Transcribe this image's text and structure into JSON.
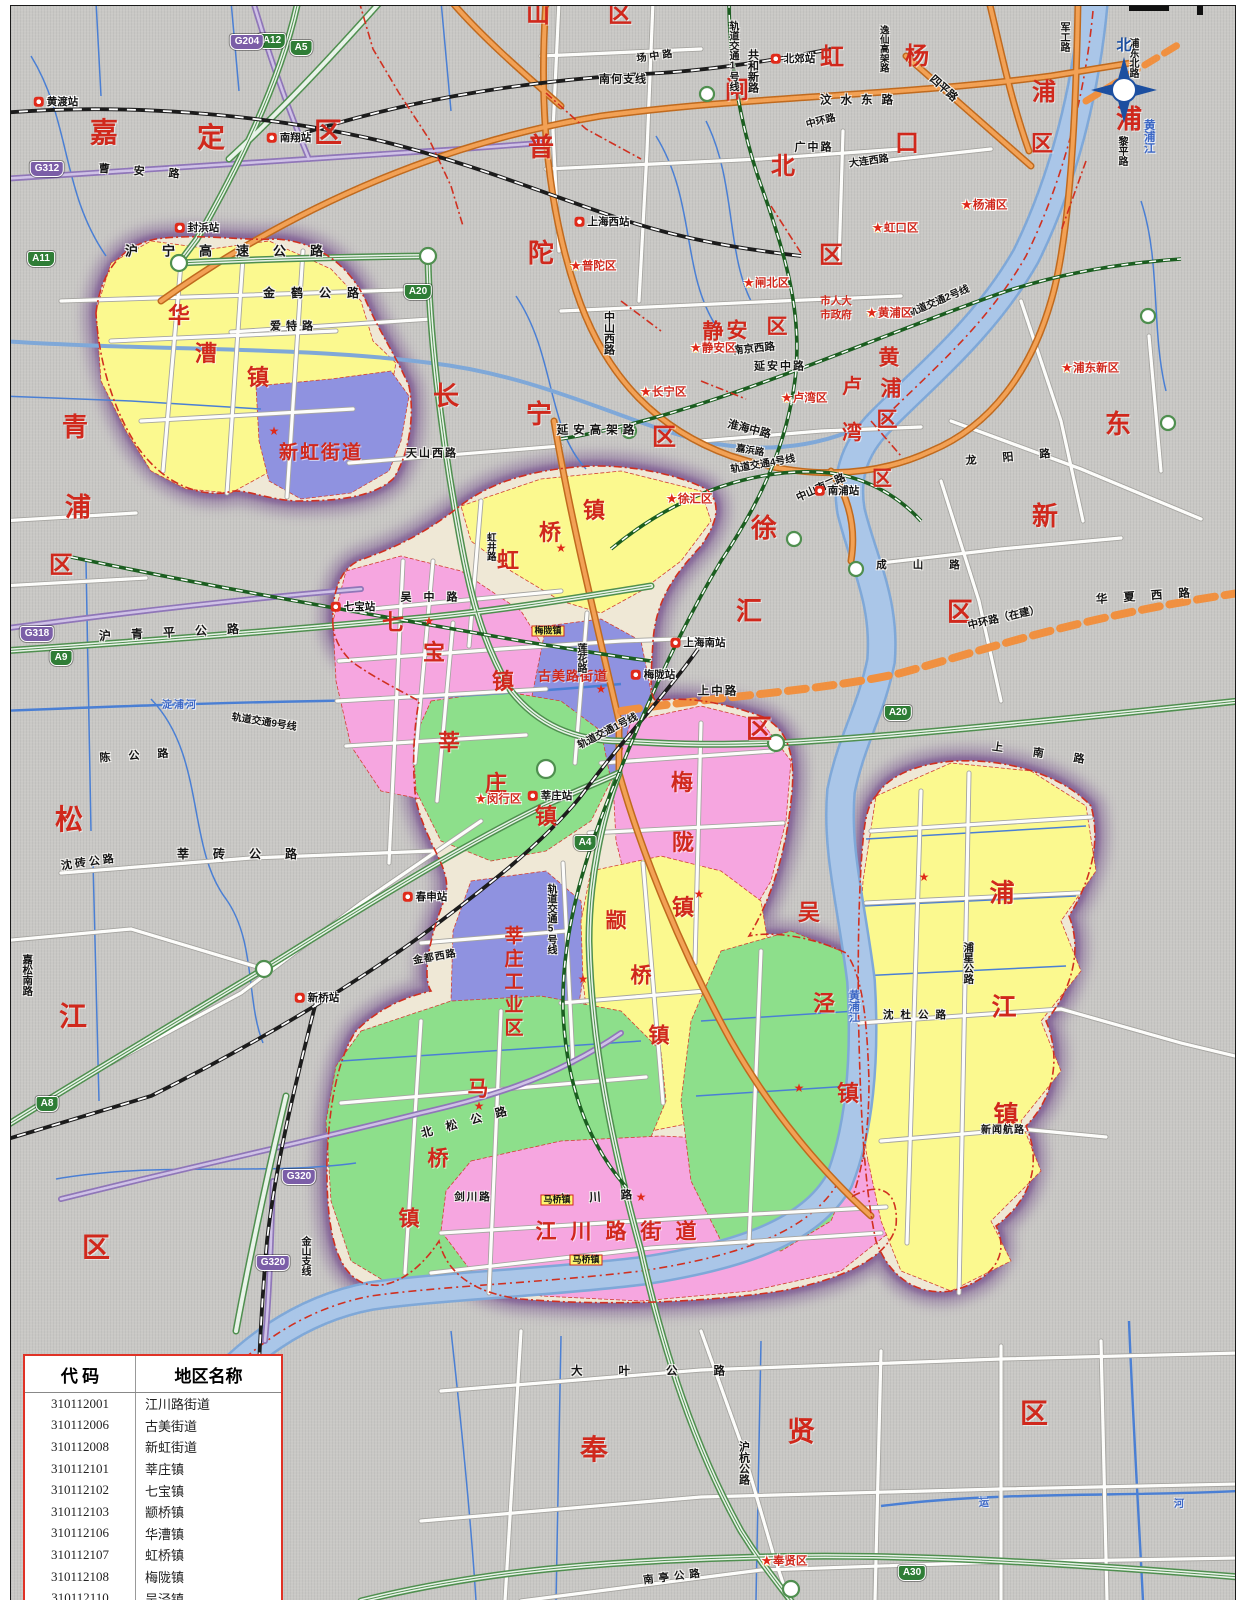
{
  "palette": {
    "bg": "#c9c8c5",
    "yellow_town": "#fbf98f",
    "pink_town": "#f6a6e0",
    "green_town": "#8ddf8b",
    "violet_town": "#8f92e0",
    "halo_purple": "#6d4388",
    "district_red": "#d0281c",
    "highway_green": "#4f8f4f",
    "major_orange": "#cf7a26",
    "g_road_purple": "#8f76b8",
    "river_blue": "#a9c5e6",
    "legend_border": "#e03226"
  },
  "compass": {
    "north_label": "北"
  },
  "legend": {
    "header": {
      "code": "代 码",
      "name": "地区名称"
    },
    "rows": [
      {
        "code": "310112001",
        "name": "江川路街道"
      },
      {
        "code": "310112006",
        "name": "古美街道"
      },
      {
        "code": "310112008",
        "name": "新虹街道"
      },
      {
        "code": "310112101",
        "name": "莘庄镇"
      },
      {
        "code": "310112102",
        "name": "七宝镇"
      },
      {
        "code": "310112103",
        "name": "颛桥镇"
      },
      {
        "code": "310112106",
        "name": "华漕镇"
      },
      {
        "code": "310112107",
        "name": "虹桥镇"
      },
      {
        "code": "310112108",
        "name": "梅陇镇"
      },
      {
        "code": "310112110",
        "name": "吴泾镇"
      },
      {
        "code": "310112112",
        "name": "马桥镇"
      },
      {
        "code": "310112114",
        "name": "浦江镇"
      },
      {
        "code": "310112501",
        "name": "莘庄工业区"
      }
    ]
  },
  "districts": [
    {
      "t": "嘉",
      "x": 103,
      "y": 133,
      "s": 28
    },
    {
      "t": "定",
      "x": 210,
      "y": 138,
      "s": 28
    },
    {
      "t": "区",
      "x": 327,
      "y": 133,
      "s": 28
    },
    {
      "t": "山",
      "x": 537,
      "y": 14,
      "s": 24
    },
    {
      "t": "区",
      "x": 619,
      "y": 14,
      "s": 24
    },
    {
      "t": "普",
      "x": 540,
      "y": 147,
      "s": 26
    },
    {
      "t": "陀",
      "x": 540,
      "y": 253,
      "s": 26
    },
    {
      "t": "区",
      "x": 830,
      "y": 255,
      "s": 24
    },
    {
      "t": "闸",
      "x": 736,
      "y": 90,
      "s": 24
    },
    {
      "t": "北",
      "x": 782,
      "y": 166,
      "s": 24
    },
    {
      "t": "虹",
      "x": 831,
      "y": 57,
      "s": 24
    },
    {
      "t": "口",
      "x": 906,
      "y": 143,
      "s": 24
    },
    {
      "t": "杨",
      "x": 916,
      "y": 56,
      "s": 24
    },
    {
      "t": "浦",
      "x": 1043,
      "y": 92,
      "s": 24
    },
    {
      "t": "区",
      "x": 1041,
      "y": 143,
      "s": 22
    },
    {
      "t": "浦",
      "x": 1128,
      "y": 119,
      "s": 26
    },
    {
      "t": "东",
      "x": 1117,
      "y": 424,
      "s": 26
    },
    {
      "t": "新",
      "x": 1044,
      "y": 516,
      "s": 26
    },
    {
      "t": "区",
      "x": 959,
      "y": 612,
      "s": 26
    },
    {
      "t": "青",
      "x": 74,
      "y": 427,
      "s": 26
    },
    {
      "t": "浦",
      "x": 77,
      "y": 507,
      "s": 26
    },
    {
      "t": "区",
      "x": 60,
      "y": 565,
      "s": 24
    },
    {
      "t": "长",
      "x": 445,
      "y": 396,
      "s": 26
    },
    {
      "t": "宁",
      "x": 538,
      "y": 414,
      "s": 26
    },
    {
      "t": "区",
      "x": 663,
      "y": 437,
      "s": 24
    },
    {
      "t": "静",
      "x": 712,
      "y": 331,
      "s": 21
    },
    {
      "t": "安",
      "x": 736,
      "y": 330,
      "s": 21
    },
    {
      "t": "区",
      "x": 776,
      "y": 326,
      "s": 21
    },
    {
      "t": "黄",
      "x": 888,
      "y": 357,
      "s": 21
    },
    {
      "t": "浦",
      "x": 890,
      "y": 388,
      "s": 21
    },
    {
      "t": "区",
      "x": 886,
      "y": 419,
      "s": 21
    },
    {
      "t": "卢",
      "x": 851,
      "y": 386,
      "s": 20
    },
    {
      "t": "湾",
      "x": 851,
      "y": 432,
      "s": 20
    },
    {
      "t": "区",
      "x": 881,
      "y": 478,
      "s": 20
    },
    {
      "t": "徐",
      "x": 763,
      "y": 528,
      "s": 26
    },
    {
      "t": "汇",
      "x": 748,
      "y": 611,
      "s": 26
    },
    {
      "t": "区",
      "x": 758,
      "y": 729,
      "s": 26
    },
    {
      "t": "松",
      "x": 68,
      "y": 820,
      "s": 28
    },
    {
      "t": "江",
      "x": 72,
      "y": 1017,
      "s": 28
    },
    {
      "t": "区",
      "x": 95,
      "y": 1248,
      "s": 28
    },
    {
      "t": "奉",
      "x": 593,
      "y": 1450,
      "s": 28
    },
    {
      "t": "贤",
      "x": 800,
      "y": 1432,
      "s": 28
    },
    {
      "t": "区",
      "x": 1033,
      "y": 1414,
      "s": 28
    }
  ],
  "towns": [
    {
      "t": "华",
      "x": 178,
      "y": 315,
      "s": 22
    },
    {
      "t": "漕",
      "x": 205,
      "y": 353,
      "s": 22
    },
    {
      "t": "镇",
      "x": 257,
      "y": 377,
      "s": 22
    },
    {
      "t": "新虹街道",
      "x": 320,
      "y": 452,
      "s": 19,
      "ls": 2
    },
    {
      "t": "七",
      "x": 392,
      "y": 622,
      "s": 22
    },
    {
      "t": "宝",
      "x": 433,
      "y": 652,
      "s": 22
    },
    {
      "t": "镇",
      "x": 502,
      "y": 681,
      "s": 22
    },
    {
      "t": "镇",
      "x": 593,
      "y": 510,
      "s": 22
    },
    {
      "t": "桥",
      "x": 549,
      "y": 532,
      "s": 22
    },
    {
      "t": "虹",
      "x": 507,
      "y": 560,
      "s": 22
    },
    {
      "t": "古美路街道",
      "x": 572,
      "y": 675,
      "s": 13,
      "ls": 1
    },
    {
      "t": "莘",
      "x": 448,
      "y": 742,
      "s": 22
    },
    {
      "t": "庄",
      "x": 495,
      "y": 783,
      "s": 22
    },
    {
      "t": "镇",
      "x": 545,
      "y": 816,
      "s": 22
    },
    {
      "t": "莘庄工业区",
      "x": 511,
      "y": 982,
      "s": 19,
      "v": 1,
      "ls": 4
    },
    {
      "t": "颛",
      "x": 615,
      "y": 920,
      "s": 21
    },
    {
      "t": "桥",
      "x": 640,
      "y": 975,
      "s": 21
    },
    {
      "t": "镇",
      "x": 658,
      "y": 1035,
      "s": 21
    },
    {
      "t": "梅",
      "x": 681,
      "y": 782,
      "s": 22
    },
    {
      "t": "陇",
      "x": 682,
      "y": 842,
      "s": 22
    },
    {
      "t": "镇",
      "x": 682,
      "y": 907,
      "s": 22
    },
    {
      "t": "吴",
      "x": 808,
      "y": 912,
      "s": 22
    },
    {
      "t": "泾",
      "x": 823,
      "y": 1003,
      "s": 22
    },
    {
      "t": "镇",
      "x": 847,
      "y": 1093,
      "s": 22
    },
    {
      "t": "马",
      "x": 477,
      "y": 1088,
      "s": 21
    },
    {
      "t": "桥",
      "x": 437,
      "y": 1158,
      "s": 21
    },
    {
      "t": "镇",
      "x": 408,
      "y": 1218,
      "s": 21
    },
    {
      "t": "江川路街道",
      "x": 622,
      "y": 1231,
      "s": 21,
      "ls": 14
    },
    {
      "t": "浦",
      "x": 1001,
      "y": 893,
      "s": 25
    },
    {
      "t": "江",
      "x": 1003,
      "y": 1007,
      "s": 25
    },
    {
      "t": "镇",
      "x": 1005,
      "y": 1115,
      "s": 25
    }
  ],
  "roads": [
    {
      "t": "沪宁高速公路",
      "x": 235,
      "y": 250,
      "s": 13,
      "ls": 24
    },
    {
      "t": "金鹤公路",
      "x": 318,
      "y": 292,
      "s": 12,
      "ls": 16
    },
    {
      "t": "爱特路",
      "x": 293,
      "y": 326,
      "s": 11,
      "ls": 5
    },
    {
      "t": "曹安路",
      "x": 150,
      "y": 172,
      "s": 11,
      "ls": 24,
      "r": 4
    },
    {
      "t": "南何支线",
      "x": 622,
      "y": 79,
      "s": 11,
      "ls": 1
    },
    {
      "t": "场中路",
      "x": 655,
      "y": 56,
      "s": 10,
      "ls": 3,
      "r": -8
    },
    {
      "t": "汶水东路",
      "x": 860,
      "y": 100,
      "s": 11.5,
      "ls": 9
    },
    {
      "t": "共和新路",
      "x": 751,
      "y": 70,
      "s": 11,
      "v": 1
    },
    {
      "t": "逸仙高架路",
      "x": 882,
      "y": 48,
      "s": 9.5,
      "v": 1
    },
    {
      "t": "中环路",
      "x": 820,
      "y": 121,
      "s": 10,
      "r": -14
    },
    {
      "t": "广中路",
      "x": 813,
      "y": 147,
      "s": 11,
      "ls": 2
    },
    {
      "t": "大连西路",
      "x": 868,
      "y": 161,
      "s": 10,
      "r": -8
    },
    {
      "t": "四平路",
      "x": 942,
      "y": 88,
      "s": 11,
      "r": 42
    },
    {
      "t": "军工路",
      "x": 1062,
      "y": 36,
      "s": 10,
      "v": 1
    },
    {
      "t": "浦东北路",
      "x": 1131,
      "y": 57,
      "s": 10,
      "v": 1
    },
    {
      "t": "黎平路",
      "x": 1120,
      "y": 150,
      "s": 10,
      "v": 1
    },
    {
      "t": "中山西路",
      "x": 607,
      "y": 332,
      "s": 11,
      "v": 1
    },
    {
      "t": "延安高架路",
      "x": 597,
      "y": 430,
      "s": 11.5,
      "ls": 5
    },
    {
      "t": "延安中路",
      "x": 779,
      "y": 366,
      "s": 11,
      "ls": 2
    },
    {
      "t": "南京西路",
      "x": 753,
      "y": 348,
      "s": 10.5,
      "r": -6
    },
    {
      "t": "淮海中路",
      "x": 748,
      "y": 429,
      "s": 11,
      "r": 14
    },
    {
      "t": "嘉浜路",
      "x": 749,
      "y": 450,
      "s": 9.5,
      "r": 10
    },
    {
      "t": "中山南二路",
      "x": 820,
      "y": 487,
      "s": 10.5,
      "r": -24
    },
    {
      "t": "轨道交通4号线",
      "x": 762,
      "y": 464,
      "s": 10,
      "r": -10
    },
    {
      "t": "轨道交通2号线",
      "x": 938,
      "y": 301,
      "s": 10,
      "r": -23
    },
    {
      "t": "轨道交通1号线",
      "x": 731,
      "y": 55,
      "s": 10,
      "v": 1
    },
    {
      "t": "轨道交通1号线",
      "x": 607,
      "y": 731,
      "s": 10,
      "r": -27
    },
    {
      "t": "轨道交通5号线",
      "x": 549,
      "y": 918,
      "s": 10,
      "v": 1
    },
    {
      "t": "轨道交通9号线",
      "x": 263,
      "y": 722,
      "s": 10,
      "r": 9
    },
    {
      "t": "天山西路",
      "x": 431,
      "y": 453,
      "s": 11,
      "ls": 2
    },
    {
      "t": "虹井路",
      "x": 489,
      "y": 546,
      "s": 9.5,
      "v": 1
    },
    {
      "t": "吴中路",
      "x": 434,
      "y": 597,
      "s": 11,
      "ls": 12
    },
    {
      "t": "莲花路",
      "x": 579,
      "y": 657,
      "s": 10,
      "v": 1
    },
    {
      "t": "上中路",
      "x": 717,
      "y": 691,
      "s": 11.5,
      "ls": 2
    },
    {
      "t": "龙阳路",
      "x": 1020,
      "y": 456,
      "s": 11,
      "ls": 26,
      "r": -5
    },
    {
      "t": "成山路",
      "x": 930,
      "y": 564,
      "s": 10.5,
      "ls": 26
    },
    {
      "t": "华夏西路",
      "x": 1150,
      "y": 596,
      "s": 11.5,
      "ls": 16,
      "r": -4
    },
    {
      "t": "中环路（在建）",
      "x": 1003,
      "y": 617,
      "s": 10.5,
      "r": -13
    },
    {
      "t": "上南路",
      "x": 1052,
      "y": 755,
      "s": 11,
      "ls": 30,
      "r": 8
    },
    {
      "t": "沪青平公路",
      "x": 178,
      "y": 631,
      "s": 12,
      "ls": 20,
      "r": -3
    },
    {
      "t": "陈公路",
      "x": 142,
      "y": 755,
      "s": 11,
      "ls": 18,
      "r": -4
    },
    {
      "t": "沈砖公路",
      "x": 88,
      "y": 862,
      "s": 11,
      "ls": 3,
      "r": -8
    },
    {
      "t": "莘砖公路",
      "x": 248,
      "y": 853,
      "s": 12,
      "ls": 24
    },
    {
      "t": "嘉松南路",
      "x": 26,
      "y": 974,
      "s": 10.5,
      "v": 1
    },
    {
      "t": "金都西路",
      "x": 434,
      "y": 957,
      "s": 10,
      "ls": 1,
      "r": -10
    },
    {
      "t": "北松公路",
      "x": 470,
      "y": 1121,
      "s": 11.5,
      "ls": 14,
      "r": -15
    },
    {
      "t": "金山支线",
      "x": 303,
      "y": 1255,
      "s": 10,
      "v": 1
    },
    {
      "t": "剑川路",
      "x": 472,
      "y": 1196,
      "s": 10.5,
      "ls": 2
    },
    {
      "t": "东川路",
      "x": 604,
      "y": 1197,
      "s": 11.5,
      "ls": 20,
      "r": -4
    },
    {
      "t": "沈杜公路",
      "x": 917,
      "y": 1014,
      "s": 10.5,
      "ls": 7
    },
    {
      "t": "浦星公路",
      "x": 967,
      "y": 962,
      "s": 10.5,
      "v": 1
    },
    {
      "t": "新闻航路",
      "x": 1002,
      "y": 1130,
      "s": 10,
      "ls": 1
    },
    {
      "t": "大叶公路",
      "x": 665,
      "y": 1371,
      "s": 11.5,
      "ls": 36
    },
    {
      "t": "沪杭公路",
      "x": 742,
      "y": 1462,
      "s": 11,
      "v": 1
    },
    {
      "t": "南亭公路",
      "x": 673,
      "y": 1576,
      "s": 10.5,
      "ls": 5,
      "r": -7
    }
  ],
  "rivers": [
    {
      "t": "黄浦江",
      "x": 1147,
      "y": 135,
      "s": 11.5,
      "v": 1
    },
    {
      "t": "黄浦江",
      "x": 852,
      "y": 1005,
      "s": 11,
      "v": 1
    },
    {
      "t": "淀浦河",
      "x": 179,
      "y": 705,
      "s": 10,
      "ls": 2
    },
    {
      "t": "运",
      "x": 983,
      "y": 1503,
      "s": 10
    },
    {
      "t": "河",
      "x": 1178,
      "y": 1504,
      "s": 10
    }
  ],
  "stations": [
    {
      "t": "黄渡站",
      "x": 55,
      "y": 101
    },
    {
      "t": "南翔站",
      "x": 288,
      "y": 137
    },
    {
      "t": "封浜站",
      "x": 196,
      "y": 227
    },
    {
      "t": "上海西站",
      "x": 601,
      "y": 221
    },
    {
      "t": "北郊站",
      "x": 792,
      "y": 58
    },
    {
      "t": "七宝站",
      "x": 352,
      "y": 606
    },
    {
      "t": "莘庄站",
      "x": 549,
      "y": 795
    },
    {
      "t": "春申站",
      "x": 424,
      "y": 896
    },
    {
      "t": "新桥站",
      "x": 316,
      "y": 997
    },
    {
      "t": "上海南站",
      "x": 697,
      "y": 642
    },
    {
      "t": "南浦站",
      "x": 836,
      "y": 490
    },
    {
      "t": "梅陇站",
      "x": 652,
      "y": 674
    }
  ],
  "gov_markers": [
    {
      "t": "普陀区",
      "x": 592,
      "y": 266
    },
    {
      "t": "闸北区",
      "x": 765,
      "y": 283
    },
    {
      "t": "静安区",
      "x": 712,
      "y": 348
    },
    {
      "t": "长宁区",
      "x": 662,
      "y": 392
    },
    {
      "t": "黄浦区",
      "x": 888,
      "y": 313
    },
    {
      "t": "卢湾区",
      "x": 803,
      "y": 398
    },
    {
      "t": "虹口区",
      "x": 894,
      "y": 228
    },
    {
      "t": "杨浦区",
      "x": 983,
      "y": 205
    },
    {
      "t": "浦东新区",
      "x": 1089,
      "y": 368
    },
    {
      "t": "徐汇区",
      "x": 688,
      "y": 499
    },
    {
      "t": "闵行区",
      "x": 497,
      "y": 799
    },
    {
      "t": "奉贤区",
      "x": 783,
      "y": 1561
    }
  ],
  "notes": [
    {
      "t": "市人大",
      "x": 835,
      "y": 300,
      "s": 10.5
    },
    {
      "t": "市政府",
      "x": 835,
      "y": 314,
      "s": 10.5
    }
  ],
  "seat_stars": [
    {
      "x": 273,
      "y": 430
    },
    {
      "x": 428,
      "y": 620
    },
    {
      "x": 560,
      "y": 547
    },
    {
      "x": 600,
      "y": 688
    },
    {
      "x": 698,
      "y": 893
    },
    {
      "x": 582,
      "y": 978
    },
    {
      "x": 478,
      "y": 1105
    },
    {
      "x": 640,
      "y": 1196
    },
    {
      "x": 798,
      "y": 1087
    },
    {
      "x": 923,
      "y": 876
    }
  ],
  "place_boxes": [
    {
      "t": "梅陇镇",
      "x": 547,
      "y": 630
    },
    {
      "t": "马桥镇",
      "x": 556,
      "y": 1199
    },
    {
      "t": "马桥镇",
      "x": 585,
      "y": 1259
    }
  ],
  "shields": [
    {
      "t": "A5",
      "x": 300,
      "y": 47,
      "k": "A"
    },
    {
      "t": "A12",
      "x": 271,
      "y": 40,
      "k": "A"
    },
    {
      "t": "G204",
      "x": 246,
      "y": 41,
      "k": "G"
    },
    {
      "t": "G312",
      "x": 46,
      "y": 168,
      "k": "G"
    },
    {
      "t": "A11",
      "x": 40,
      "y": 258,
      "k": "A"
    },
    {
      "t": "A20",
      "x": 417,
      "y": 291,
      "k": "A"
    },
    {
      "t": "A20",
      "x": 897,
      "y": 712,
      "k": "A"
    },
    {
      "t": "G318",
      "x": 36,
      "y": 633,
      "k": "G"
    },
    {
      "t": "A9",
      "x": 60,
      "y": 657,
      "k": "A"
    },
    {
      "t": "A8",
      "x": 46,
      "y": 1103,
      "k": "A"
    },
    {
      "t": "A4",
      "x": 584,
      "y": 842,
      "k": "A"
    },
    {
      "t": "G320",
      "x": 298,
      "y": 1176,
      "k": "G"
    },
    {
      "t": "G320",
      "x": 272,
      "y": 1262,
      "k": "G"
    },
    {
      "t": "A30",
      "x": 911,
      "y": 1572,
      "k": "A"
    }
  ]
}
